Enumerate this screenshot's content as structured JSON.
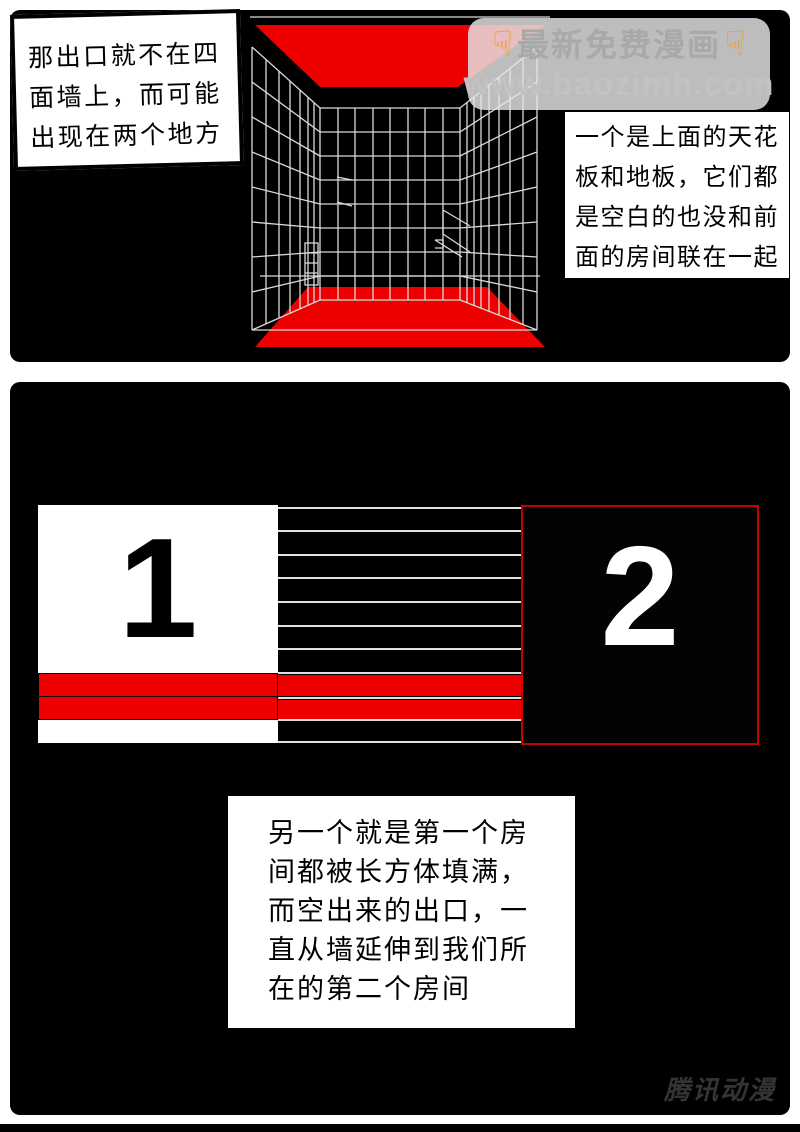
{
  "colors": {
    "accent_red": "#ee0000",
    "room2_border_red": "#c40000",
    "wireframe_grid": "#d9d9d9",
    "page_background": "#ffffff",
    "panel_background": "#000000"
  },
  "panel1": {
    "speech_bubble": {
      "lines": [
        "那出口就不在四",
        "面墙上，而可能",
        "出现在两个地方"
      ]
    },
    "watermark": {
      "finger_icon": "☟",
      "title": "最新免费漫画",
      "url": "www.baozimh.com"
    },
    "infobox": {
      "lines": [
        "一个是上面的天花",
        "板和地板，它们都",
        "是空白的也没和前",
        "面的房间联在一起"
      ]
    }
  },
  "panel2": {
    "room1_label": "1",
    "room2_label": "2",
    "textbox": {
      "lines": [
        "另一个就是第一个房",
        "间都被长方体填满，",
        "而空出来的出口，一",
        "直从墙延伸到我们所",
        "在的第二个房间"
      ]
    },
    "publisher": "腾讯动漫"
  }
}
